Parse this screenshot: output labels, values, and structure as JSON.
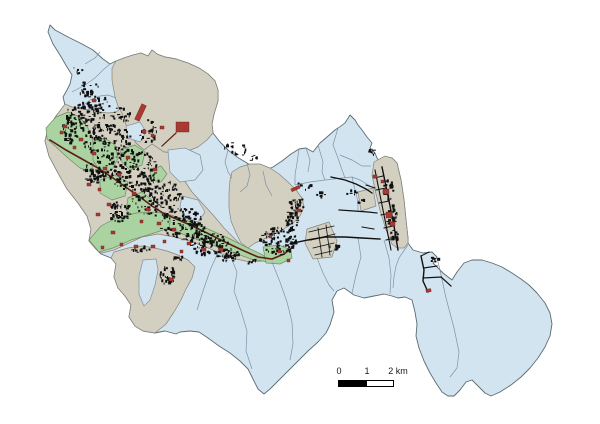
{
  "figure": {
    "background": "#ffffff",
    "description": "Municipal district map with building footprints"
  },
  "colors": {
    "blue": "#d3e4f1",
    "tan": "#d3cfc1",
    "green": "#abd2a1",
    "blue_stroke": "#7d93a2",
    "tan_stroke": "#85857a",
    "green_stroke": "#6f8f65",
    "outer": "#5b6b73",
    "black": "#101010",
    "maroon": "#5c1f1a",
    "red": "#a93a33",
    "red_stroke": "#6b211c",
    "text": "#1a1a1a",
    "bar_black": "#000000",
    "bar_white": "#ffffff"
  },
  "scalebar": {
    "labels": [
      "0",
      "1",
      "2 km"
    ]
  },
  "map": {
    "outline": "50,25 55,30 68,37 82,44 93,50 103,59 110,64 116,61 124,58 133,55 141,53 148,56 152,50 157,54 165,57 176,59 188,63 199,68 208,74 215,81 218,90 218,101 214,114 212,124 213,133 220,142 228,150 237,157 247,163 256,169 264,171 273,167 282,161 291,154 299,149 306,148 313,152 320,143 327,137 335,130 341,126 345,123 350,115 355,120 358,125 362,130 367,137 372,143 370,148 375,153 377,158 380,162 386,157 392,158 397,163 401,180 404,200 406,220 408,238 408,243 413,250 423,253 432,252 437,257 433,263 438,268 443,273 452,280 457,272 464,263 472,260 482,260 492,263 502,267 512,273 521,279 529,285 537,293 545,303 550,313 552,324 550,336 545,347 538,358 530,368 521,377 511,385 500,392 491,396 485,393 478,386 472,380 466,382 460,390 454,396 448,396 442,392 436,383 430,373 424,361 419,348 416,336 417,324 415,312 412,300 405,297 398,298 392,296 384,294 374,296 364,298 354,295 344,288 337,291 332,300 334,312 330,325 326,333 318,342 308,351 298,361 288,371 278,381 270,389 264,394 258,389 253,379 248,369 240,361 230,353 219,346 208,338 199,332 190,331 180,332 176,334 165,331 155,333 143,331 135,326 129,317 131,305 125,296 118,288 114,277 116,264 111,258 101,254 95,248 89,241 91,229 87,216 78,203 67,189 58,173 49,156 45,141 48,129 56,116 65,105 63,97 67,90 70,84 72,75 67,67 60,55 53,44 48,32",
    "districts": [
      {
        "n": "north-tan-district",
        "f": "tan",
        "p": "116,61 124,58 133,55 141,53 148,56 152,50 157,54 165,57 176,59 188,63 199,68 208,74 215,81 218,90 218,101 214,114 212,124 213,133 207,140 198,147 188,151 176,153 164,152 152,144 144,150 136,143 128,131 121,115 115,97 112,80 112,68"
      },
      {
        "n": "west-urban-district",
        "f": "tan",
        "p": "65,104 72,107 82,109 92,110 100,112 108,113 116,112 120,109 124,118 128,131 136,143 144,150 152,144 164,152 176,153 183,157 180,168 184,180 192,192 203,204 214,216 224,228 234,238 244,248 254,256 262,261 250,262 236,259 222,254 206,247 190,241 174,237 158,234 142,237 127,244 114,250 102,253 95,248 89,241 91,229 87,216 78,203 67,189 58,173 49,156 45,141 48,129 56,116"
      },
      {
        "n": "southwest-tan-district",
        "f": "tan",
        "p": "114,252 128,248 142,246 155,248 167,251 178,255 188,260 195,267 192,278 186,289 181,300 174,312 166,324 155,333 143,331 135,326 129,317 131,305 125,296 118,288 114,277 116,264 111,258"
      },
      {
        "n": "central-tan-district",
        "f": "tan",
        "p": "232,172 240,167 250,164 260,164 270,168 279,174 288,182 296,190 302,198 304,207 300,216 293,223 284,229 274,234 264,239 255,243 248,248 241,243 236,233 231,221 229,208 229,193 230,180"
      },
      {
        "n": "central-tan-parcel",
        "f": "tan",
        "p": "307,229 329,222 337,241 332,257 313,259 305,243"
      },
      {
        "n": "northeast-tan-strip",
        "f": "tan",
        "p": "374,162 385,156 392,158 397,163 401,180 404,200 406,220 408,238 408,243 404,248 397,248 392,244 386,230 380,210 375,190 372,175"
      },
      {
        "n": "northeast-tan-wing",
        "f": "tan",
        "p": "358,192 373,188 376,206 361,211"
      },
      {
        "n": "southwest-blue-enclave",
        "f": "blue",
        "p": "143,260 156,259 158,270 155,285 150,300 144,306 139,294 139,276"
      },
      {
        "n": "urban-blue-parcel-1",
        "f": "blue",
        "p": "168,150 185,148 200,155 203,170 195,180 180,182 170,172"
      },
      {
        "n": "urban-blue-parcel-2",
        "f": "blue",
        "p": "126,126 140,122 146,132 140,142 128,138"
      },
      {
        "n": "urban-blue-parcel-3",
        "f": "blue",
        "p": "182,196 198,200 205,212 198,222 185,218 180,207"
      },
      {
        "n": "green-parcel-1",
        "f": "green",
        "p": "46,128 56,117 68,112 80,117 88,128 93,142 96,158 91,172 80,168 68,158 56,147 47,139"
      },
      {
        "n": "green-parcel-2",
        "f": "green",
        "p": "93,142 105,138 115,145 118,158 112,170 100,172 93,160"
      },
      {
        "n": "green-parcel-3",
        "f": "green",
        "p": "120,150 135,145 145,152 142,165 130,170 122,162"
      },
      {
        "n": "green-parcel-4",
        "f": "green",
        "p": "100,180 115,175 128,182 125,196 112,200 100,193"
      },
      {
        "n": "green-parcel-5",
        "f": "green",
        "p": "128,198 142,192 152,200 148,214 135,218 126,210"
      },
      {
        "n": "green-parcel-6",
        "f": "green",
        "p": "89,240 101,226 116,218 136,213 156,212 171,215 169,228 151,234 131,240 113,248 99,252"
      },
      {
        "n": "green-parcel-7",
        "f": "green",
        "p": "171,215 188,221 208,229 228,238 248,248 263,255 268,262 251,259 229,251 207,243 187,236 169,228"
      },
      {
        "n": "green-parcel-8",
        "f": "green",
        "p": "263,247 279,245 291,250 292,258 280,264 266,263"
      },
      {
        "n": "green-parcel-9",
        "f": "green",
        "p": "150,170 161,166 167,174 161,182 151,180"
      }
    ],
    "borders": [
      "85,64 95,58 100,52",
      "72,92 85,85 95,78 103,70 110,64",
      "80,108 90,100 100,96 108,95 116,98",
      "263,171 266,185 272,196",
      "299,149 297,163 295,175 295,185",
      "306,148 310,160 308,172",
      "345,123 338,128 333,145 338,158 342,170 345,178",
      "318,145 323,162 322,172 325,180",
      "295,185 310,182 325,180 342,178 352,177 360,180 370,186",
      "352,177 355,190 358,202 358,211",
      "340,155 352,160 362,166 371,166",
      "197,310 204,288 211,268 217,255 222,251",
      "230,255 237,272 234,291 241,311 247,331 246,351 252,369",
      "272,262 280,282 287,302 292,322 293,344 290,360",
      "317,258 323,273 329,285 334,291",
      "358,238 361,257 356,275 352,293",
      "384,240 389,258 391,275 390,294",
      "408,245 403,252 399,258 396,266 394,277 393,288",
      "437,258 440,270 446,298 454,328 459,352 457,368 450,377",
      "247,163 250,175 247,186 240,192",
      "228,150 225,162 228,172 232,178"
    ],
    "roads": [
      {
        "c": "m",
        "w": 1.6,
        "p": "50,140 66,150 82,159 98,168 113,178 127,188 140,197 152,206 163,213 174,218 188,224 205,232 223,241 242,250 258,257 272,259 284,254 293,247"
      },
      {
        "c": "m",
        "w": 1.2,
        "p": "176,133 162,146"
      },
      {
        "c": "k",
        "w": 1.4,
        "p": "293,243 308,240 325,237 345,237 362,238 380,239"
      },
      {
        "c": "k",
        "w": 1.3,
        "p": "331,177 345,180 356,184 366,189 372,193"
      },
      {
        "c": "k",
        "w": 1.2,
        "p": "339,210 354,211 368,212 377,213"
      },
      {
        "c": "k",
        "w": 1.4,
        "p": "382,167 388,196 394,226 398,250"
      },
      {
        "c": "k",
        "w": 1.1,
        "p": "375,170 381,200 387,230 391,250"
      },
      {
        "c": "k",
        "w": 1,
        "p": "374,178 383,176"
      },
      {
        "c": "k",
        "w": 1,
        "p": "376,190 386,188"
      },
      {
        "c": "k",
        "w": 1,
        "p": "379,203 389,201"
      },
      {
        "c": "k",
        "w": 1,
        "p": "381,215 391,213"
      },
      {
        "c": "k",
        "w": 1,
        "p": "384,228 393,226"
      },
      {
        "c": "k",
        "w": 1,
        "p": "386,240 395,238"
      },
      {
        "c": "k",
        "w": 1,
        "p": "366,185 375,188"
      },
      {
        "c": "k",
        "w": 1,
        "p": "362,227 374,229"
      },
      {
        "c": "k",
        "w": 1.4,
        "p": "421,256 424,270 423,281 428,292"
      },
      {
        "c": "k",
        "w": 1.2,
        "p": "424,268 437,266"
      },
      {
        "c": "k",
        "w": 1.2,
        "p": "423,278 441,277"
      },
      {
        "c": "k",
        "w": 1.2,
        "p": "441,277 451,286"
      },
      {
        "c": "k",
        "w": 1,
        "p": "421,256 429,252"
      },
      {
        "c": "k",
        "w": 0.8,
        "p": "309,232 334,226"
      },
      {
        "c": "k",
        "w": 0.8,
        "p": "311,240 335,234"
      },
      {
        "c": "k",
        "w": 0.8,
        "p": "313,248 334,243"
      },
      {
        "c": "k",
        "w": 0.8,
        "p": "315,255 332,251"
      },
      {
        "c": "k",
        "w": 0.8,
        "p": "318,228 322,257"
      },
      {
        "c": "k",
        "w": 0.8,
        "p": "326,225 330,255"
      }
    ],
    "clusters": [
      [
        85,
        117,
        20,
        14,
        90
      ],
      [
        108,
        142,
        24,
        18,
        130
      ],
      [
        132,
        170,
        26,
        20,
        140
      ],
      [
        158,
        198,
        26,
        19,
        130
      ],
      [
        184,
        224,
        24,
        16,
        120
      ],
      [
        209,
        244,
        20,
        12,
        90
      ],
      [
        227,
        255,
        12,
        7,
        40
      ],
      [
        70,
        133,
        9,
        12,
        40
      ],
      [
        95,
        172,
        12,
        12,
        55
      ],
      [
        120,
        212,
        12,
        10,
        45
      ],
      [
        100,
        103,
        13,
        8,
        25
      ],
      [
        122,
        115,
        11,
        8,
        22
      ],
      [
        147,
        137,
        10,
        7,
        18
      ],
      [
        90,
        88,
        9,
        8,
        14
      ],
      [
        78,
        70,
        5,
        4,
        6
      ],
      [
        168,
        276,
        8,
        10,
        35
      ],
      [
        208,
        240,
        6,
        4,
        10
      ],
      [
        278,
        241,
        19,
        14,
        110
      ],
      [
        292,
        220,
        6,
        11,
        35
      ],
      [
        297,
        205,
        8,
        8,
        28
      ],
      [
        240,
        151,
        10,
        6,
        12
      ],
      [
        257,
        159,
        7,
        4,
        7
      ],
      [
        305,
        186,
        10,
        6,
        10
      ],
      [
        320,
        196,
        6,
        4,
        7
      ],
      [
        352,
        193,
        5,
        3,
        6
      ],
      [
        362,
        201,
        4,
        3,
        5
      ],
      [
        334,
        247,
        5,
        3,
        6
      ],
      [
        373,
        152,
        4,
        4,
        8
      ],
      [
        389,
        190,
        6,
        10,
        25
      ],
      [
        391,
        215,
        6,
        10,
        25
      ],
      [
        394,
        237,
        5,
        7,
        15
      ],
      [
        435,
        260,
        4,
        3,
        7
      ],
      [
        88,
        92,
        8,
        7,
        10
      ],
      [
        155,
        130,
        6,
        4,
        5
      ],
      [
        228,
        145,
        6,
        4,
        6
      ],
      [
        140,
        250,
        10,
        4,
        12
      ],
      [
        180,
        258,
        8,
        3,
        8
      ],
      [
        252,
        262,
        6,
        3,
        8
      ],
      [
        150,
        120,
        4,
        3,
        4
      ]
    ],
    "red_buildings": [
      [
        138,
        104,
        5,
        17,
        25
      ],
      [
        176,
        122,
        13,
        10,
        0
      ],
      [
        160,
        126,
        4,
        3,
        0
      ],
      [
        151,
        134,
        3,
        3,
        0
      ],
      [
        92,
        99,
        4,
        3,
        0
      ],
      [
        63,
        125,
        4,
        3,
        0
      ],
      [
        79,
        138,
        4,
        3,
        0
      ],
      [
        92,
        152,
        4,
        3,
        0
      ],
      [
        103,
        167,
        4,
        3,
        0
      ],
      [
        87,
        183,
        4,
        3,
        0
      ],
      [
        117,
        173,
        4,
        3,
        0
      ],
      [
        132,
        192,
        4,
        3,
        0
      ],
      [
        146,
        208,
        4,
        3,
        0
      ],
      [
        157,
        222,
        4,
        3,
        0
      ],
      [
        126,
        156,
        4,
        3,
        0
      ],
      [
        142,
        130,
        4,
        3,
        0
      ],
      [
        153,
        168,
        4,
        3,
        0
      ],
      [
        172,
        228,
        4,
        3,
        0
      ],
      [
        187,
        242,
        4,
        3,
        0
      ],
      [
        202,
        248,
        4,
        3,
        0
      ],
      [
        169,
        278,
        4,
        3,
        0
      ],
      [
        219,
        248,
        4,
        3,
        0
      ],
      [
        107,
        203,
        4,
        3,
        0
      ],
      [
        96,
        213,
        4,
        3,
        0
      ],
      [
        111,
        231,
        4,
        3,
        0
      ],
      [
        134,
        245,
        4,
        3,
        0
      ],
      [
        151,
        245,
        4,
        3,
        0
      ],
      [
        60,
        131,
        3,
        3,
        0
      ],
      [
        73,
        146,
        3,
        3,
        0
      ],
      [
        98,
        188,
        3,
        3,
        0
      ],
      [
        140,
        220,
        3,
        3,
        0
      ],
      [
        163,
        240,
        3,
        3,
        0
      ],
      [
        180,
        250,
        3,
        3,
        0
      ],
      [
        291,
        187,
        9,
        3,
        -25
      ],
      [
        297,
        209,
        4,
        3,
        0
      ],
      [
        278,
        250,
        3,
        3,
        0
      ],
      [
        287,
        259,
        3,
        3,
        0
      ],
      [
        269,
        235,
        3,
        3,
        0
      ],
      [
        383,
        189,
        6,
        5,
        0
      ],
      [
        386,
        212,
        6,
        6,
        0
      ],
      [
        390,
        222,
        5,
        4,
        0
      ],
      [
        373,
        175,
        4,
        3,
        0
      ],
      [
        381,
        180,
        3,
        3,
        0
      ],
      [
        426,
        289,
        5,
        3,
        -10
      ],
      [
        101,
        246,
        3,
        3,
        0
      ],
      [
        120,
        243,
        3,
        3,
        0
      ]
    ]
  }
}
